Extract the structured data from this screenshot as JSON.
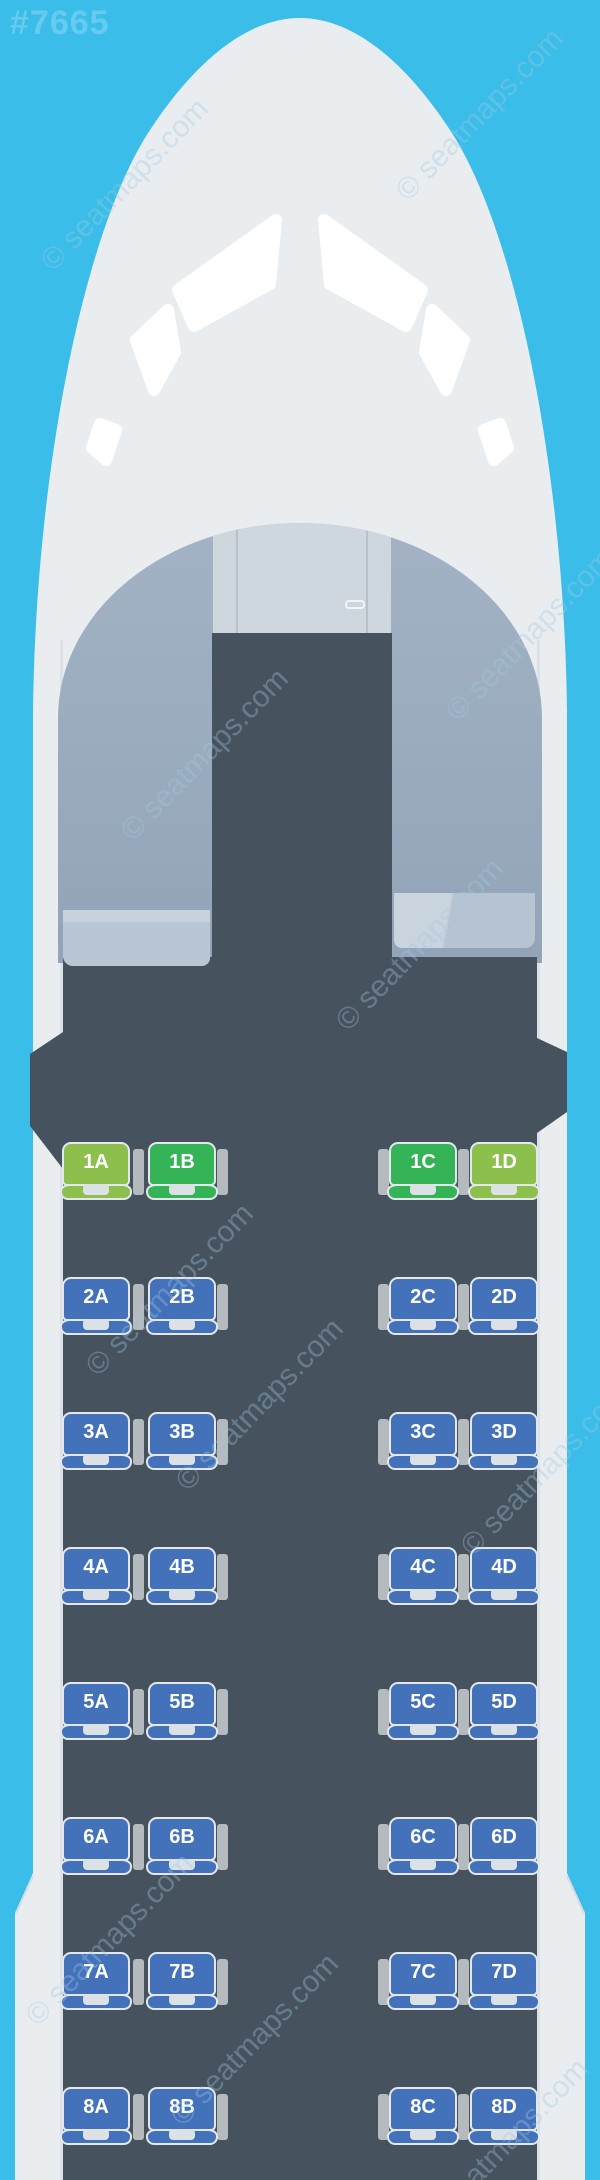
{
  "plane_id": "#7665",
  "watermark": {
    "text": "© seatmaps.com"
  },
  "colors": {
    "background": "#3bbde9",
    "fuselage": "#e9edf0",
    "cabin_floor": "#47525f",
    "dome": "#9dafc2",
    "cockpit_panel": "#ced6de",
    "premium_lime": "#8dbf4c",
    "premium_green": "#35b457",
    "standard_blue": "#4372bb",
    "seat_border": "#e4e8ec",
    "armrest": "#b5babf",
    "cushion_notch": "#dce1e6"
  },
  "cabin": {
    "layout": "2-2",
    "rows": [
      {
        "number": 1,
        "seats": [
          {
            "id": "1A",
            "letter": "A",
            "tier": "premium_lime"
          },
          {
            "id": "1B",
            "letter": "B",
            "tier": "premium_green"
          },
          {
            "id": "1C",
            "letter": "C",
            "tier": "premium_green"
          },
          {
            "id": "1D",
            "letter": "D",
            "tier": "premium_lime"
          }
        ]
      },
      {
        "number": 2,
        "seats": [
          {
            "id": "2A",
            "letter": "A",
            "tier": "standard_blue"
          },
          {
            "id": "2B",
            "letter": "B",
            "tier": "standard_blue"
          },
          {
            "id": "2C",
            "letter": "C",
            "tier": "standard_blue"
          },
          {
            "id": "2D",
            "letter": "D",
            "tier": "standard_blue"
          }
        ]
      },
      {
        "number": 3,
        "seats": [
          {
            "id": "3A",
            "letter": "A",
            "tier": "standard_blue"
          },
          {
            "id": "3B",
            "letter": "B",
            "tier": "standard_blue"
          },
          {
            "id": "3C",
            "letter": "C",
            "tier": "standard_blue"
          },
          {
            "id": "3D",
            "letter": "D",
            "tier": "standard_blue"
          }
        ]
      },
      {
        "number": 4,
        "seats": [
          {
            "id": "4A",
            "letter": "A",
            "tier": "standard_blue"
          },
          {
            "id": "4B",
            "letter": "B",
            "tier": "standard_blue"
          },
          {
            "id": "4C",
            "letter": "C",
            "tier": "standard_blue"
          },
          {
            "id": "4D",
            "letter": "D",
            "tier": "standard_blue"
          }
        ]
      },
      {
        "number": 5,
        "seats": [
          {
            "id": "5A",
            "letter": "A",
            "tier": "standard_blue"
          },
          {
            "id": "5B",
            "letter": "B",
            "tier": "standard_blue"
          },
          {
            "id": "5C",
            "letter": "C",
            "tier": "standard_blue"
          },
          {
            "id": "5D",
            "letter": "D",
            "tier": "standard_blue"
          }
        ]
      },
      {
        "number": 6,
        "seats": [
          {
            "id": "6A",
            "letter": "A",
            "tier": "standard_blue"
          },
          {
            "id": "6B",
            "letter": "B",
            "tier": "standard_blue"
          },
          {
            "id": "6C",
            "letter": "C",
            "tier": "standard_blue"
          },
          {
            "id": "6D",
            "letter": "D",
            "tier": "standard_blue"
          }
        ]
      },
      {
        "number": 7,
        "seats": [
          {
            "id": "7A",
            "letter": "A",
            "tier": "standard_blue"
          },
          {
            "id": "7B",
            "letter": "B",
            "tier": "standard_blue"
          },
          {
            "id": "7C",
            "letter": "C",
            "tier": "standard_blue"
          },
          {
            "id": "7D",
            "letter": "D",
            "tier": "standard_blue"
          }
        ]
      },
      {
        "number": 8,
        "seats": [
          {
            "id": "8A",
            "letter": "A",
            "tier": "standard_blue"
          },
          {
            "id": "8B",
            "letter": "B",
            "tier": "standard_blue"
          },
          {
            "id": "8C",
            "letter": "C",
            "tier": "standard_blue"
          },
          {
            "id": "8D",
            "letter": "D",
            "tier": "standard_blue"
          }
        ]
      }
    ]
  }
}
